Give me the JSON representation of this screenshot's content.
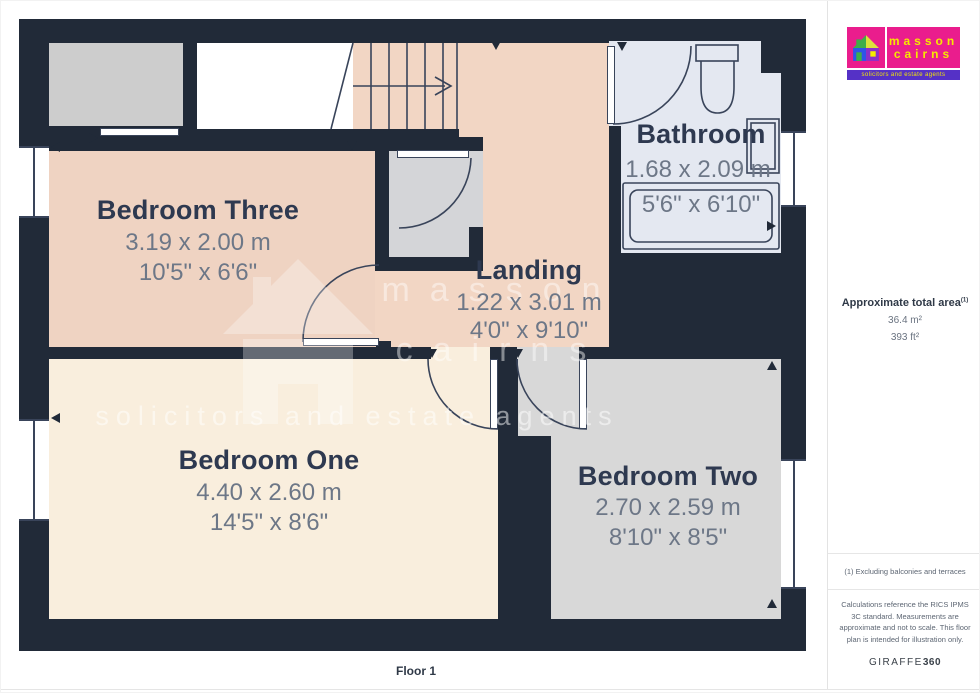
{
  "plan": {
    "floor_label": "Floor 1",
    "rooms": {
      "bedroom_three": {
        "name": "Bedroom Three",
        "metric": "3.19 x 2.00 m",
        "imperial": "10'5\" x 6'6\""
      },
      "bedroom_one": {
        "name": "Bedroom One",
        "metric": "4.40 x 2.60 m",
        "imperial": "14'5\" x 8'6\""
      },
      "bedroom_two": {
        "name": "Bedroom Two",
        "metric": "2.70 x 2.59 m",
        "imperial": "8'10\" x 8'5\""
      },
      "bathroom": {
        "name": "Bathroom",
        "metric": "1.68 x 2.09 m",
        "imperial": "5'6\" x 6'10\""
      },
      "landing": {
        "name": "Landing",
        "metric": "1.22 x 3.01 m",
        "imperial": "4'0\" x 9'10\""
      }
    },
    "colors": {
      "wall": "#212a38",
      "bedroom_peach": "#efd3c2",
      "bedroom_cream": "#f9eedd",
      "bedroom_gray": "#d8d8d8",
      "bathroom_blue": "#e4e8f1",
      "closet_gray": "#d4d5d8"
    }
  },
  "watermark": {
    "line1": "masson",
    "line2": "cairns",
    "line3": "solicitors and estate agents"
  },
  "sidebar": {
    "logo": {
      "name_line1": "masson",
      "name_line2": "cairns",
      "tagline": "solicitors and estate agents",
      "colors": {
        "pink": "#ea1d8d",
        "purple": "#5531c6",
        "yellow": "#f5e900"
      }
    },
    "area": {
      "heading": "Approximate total area",
      "superscript": "(1)",
      "metric": "36.4 m²",
      "imperial": "393 ft²"
    },
    "note1": "(1) Excluding balconies and terraces",
    "note2": "Calculations reference the RICS IPMS 3C standard. Measurements are approximate and not to scale. This floor plan is intended for illustration only.",
    "brand": {
      "name": "GIRAFFE",
      "suffix": "360"
    }
  }
}
